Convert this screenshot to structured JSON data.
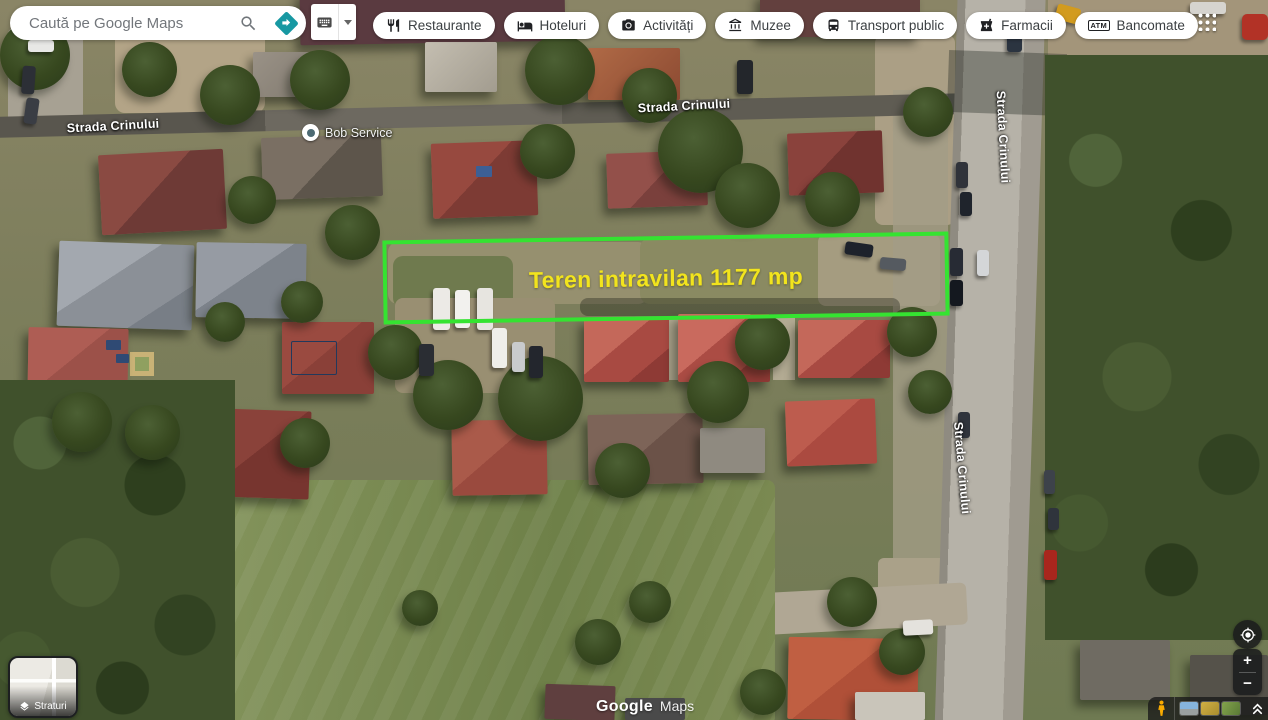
{
  "topbar": {
    "search": {
      "placeholder": "Caută pe Google Maps",
      "search_icon": "magnifier",
      "directions_icon": "teal-diamond-turn-arrow",
      "directions_color": "#1798a2"
    },
    "input_tool": {
      "keyboard_icon": "keyboard",
      "caret_icon": "chevron-down"
    },
    "chips": [
      {
        "label": "Restaurante",
        "icon": "restaurant-fork-knife"
      },
      {
        "label": "Hoteluri",
        "icon": "hotel-bed"
      },
      {
        "label": "Activități",
        "icon": "camera"
      },
      {
        "label": "Muzee",
        "icon": "museum-building"
      },
      {
        "label": "Transport public",
        "icon": "bus"
      },
      {
        "label": "Farmacii",
        "icon": "pharmacy-cross"
      },
      {
        "label": "Bancomate",
        "icon": "atm-letters",
        "icon_text": "ATM"
      }
    ],
    "apps_grid_icon": "3x3-dots-grid"
  },
  "map": {
    "street_labels": [
      "Strada Crinului",
      "Strada Crinului",
      "Strada Crinului",
      "Strada Crinului"
    ],
    "poi": {
      "name": "Bob Service",
      "icon": "white-circle-pin"
    },
    "plot": {
      "label": "Teren intravilan 1177 mp",
      "border_color": "#35e331",
      "label_color": "#f2e41d"
    },
    "watermark": {
      "brand": "Google",
      "product": "Maps"
    }
  },
  "controls": {
    "layers": {
      "label": "Straturi",
      "icon": "layers-stack"
    },
    "locate_icon": "my-location-target",
    "zoom_in": "+",
    "zoom_out": "−",
    "pegman_icon": "pegman",
    "collapse_icon": "double-chevron-up",
    "thumbnails": [
      "streetview-sky",
      "yellow-field",
      "green-field"
    ]
  }
}
